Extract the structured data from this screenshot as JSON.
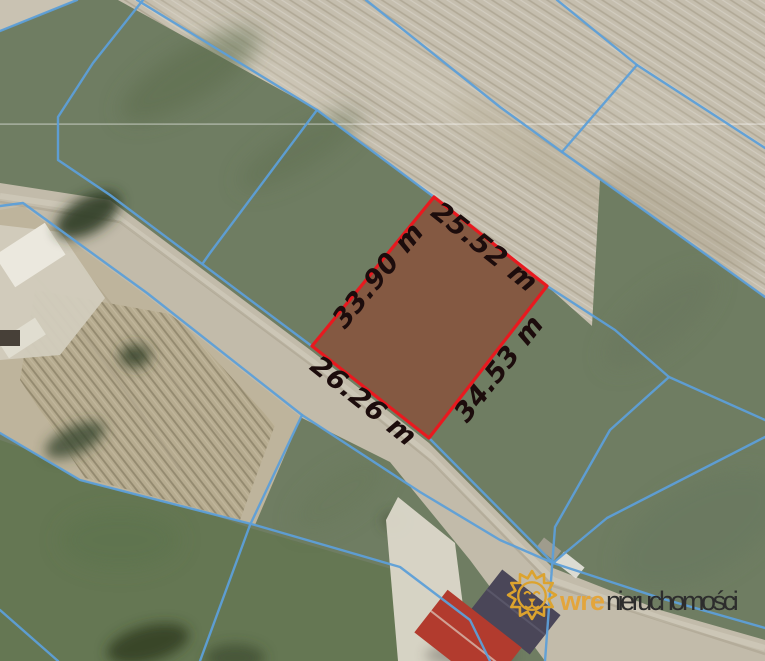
{
  "map": {
    "plot_dimensions": {
      "top_edge": "25.52 m",
      "left_edge": "33.90 m",
      "right_edge": "34.53 m",
      "bottom_edge": "26.26 m"
    },
    "colors": {
      "plot_outline": "#e8191f",
      "plot_fill": "rgba(150,60,40,0.55)",
      "parcel_lines": "#5d9fd8",
      "dimension_text": "#1c0c0c"
    }
  },
  "watermark": {
    "icon": "lion-logo",
    "brand_prefix": "wre",
    "brand_suffix": "nieruchomości",
    "colors": {
      "lion": "#dca32e",
      "prefix": "#e3a53c",
      "suffix": "#2d2d2d"
    }
  }
}
